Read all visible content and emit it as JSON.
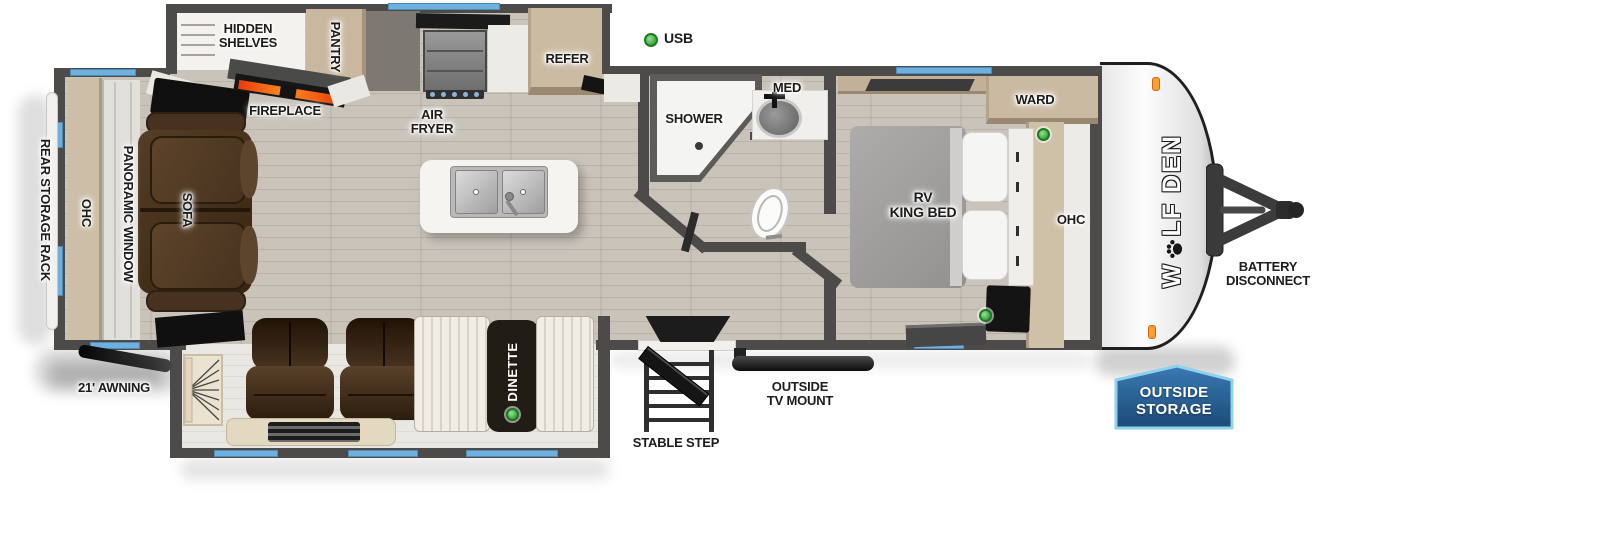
{
  "title": "Wolf Den travel trailer floorplan",
  "colors": {
    "window_blue": "#6fb0df",
    "usb_green": "#3aa33a",
    "badge_blue": "#1c4a78",
    "flame_orange": "#ff8d1f",
    "wall_gray": "#4c4b49"
  },
  "legend": {
    "usb": "USB"
  },
  "brand": {
    "logo_prefix": "W",
    "logo_suffix": "LF DEN"
  },
  "exterior": {
    "rear_storage_rack": "REAR STORAGE RACK",
    "awning": "21' AWNING",
    "stable_step": "STABLE STEP",
    "outside_tv_mount_l1": "OUTSIDE",
    "outside_tv_mount_l2": "TV MOUNT",
    "battery_l1": "BATTERY",
    "battery_l2": "DISCONNECT",
    "outside_storage_l1": "OUTSIDE",
    "outside_storage_l2": "STORAGE"
  },
  "living": {
    "ohc": "OHC",
    "panoramic_window": "PANORAMIC WINDOW",
    "sofa": "SOFA",
    "fireplace": "FIREPLACE",
    "dinette": "DINETTE"
  },
  "kitchen": {
    "hidden_shelves_l1": "HIDDEN",
    "hidden_shelves_l2": "SHELVES",
    "pantry": "PANTRY",
    "refer": "REFER",
    "air_fryer_l1": "AIR",
    "air_fryer_l2": "FRYER"
  },
  "bath": {
    "shower": "SHOWER",
    "med": "MED"
  },
  "bedroom": {
    "ward": "WARD",
    "ohc": "OHC",
    "bed_l1": "RV",
    "bed_l2": "KING BED"
  }
}
